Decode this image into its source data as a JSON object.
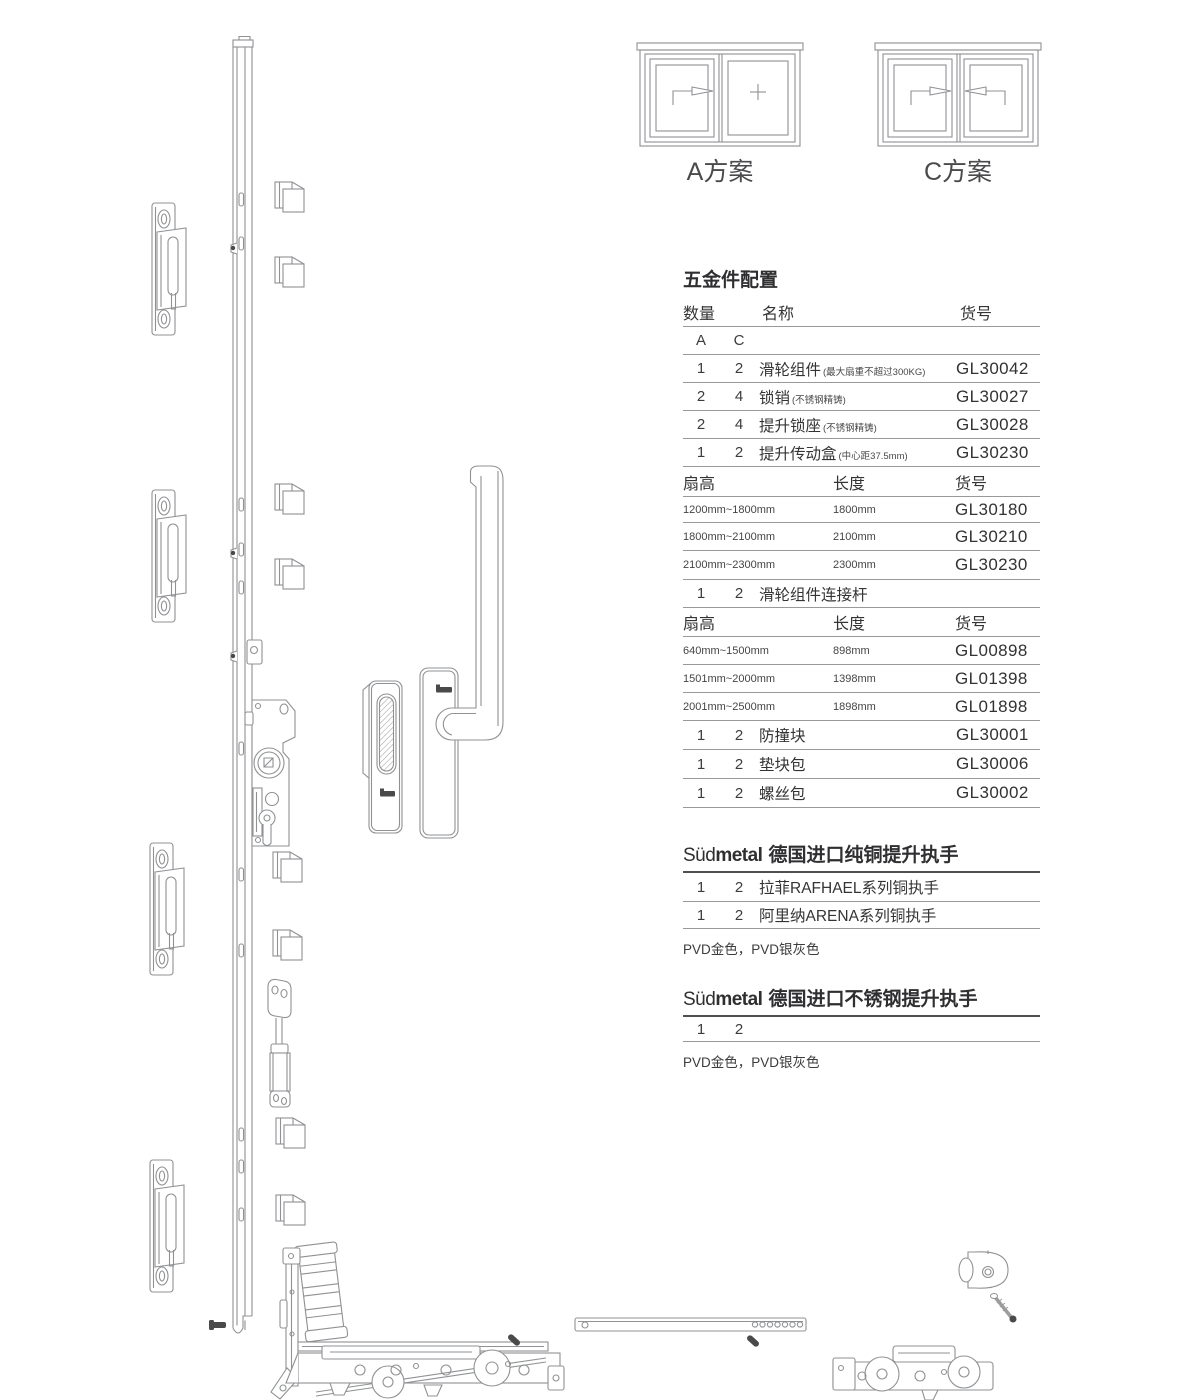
{
  "colors": {
    "line": "#8f9193",
    "text": "#3f3f41",
    "rule": "#97999b",
    "dark_rule": "#4f4f51",
    "pin_fill": "#4a4a4a",
    "background": "#ffffff"
  },
  "schemes": {
    "a": {
      "label": "A方案",
      "left_pane": "sliding-sash-arrow-right",
      "right_pane": "fixed-pane-plus"
    },
    "c": {
      "label": "C方案",
      "left_pane": "sliding-sash-arrow-right",
      "right_pane": "sliding-sash-arrow-left"
    }
  },
  "table": {
    "title": "五金件配置",
    "head": {
      "qty": "数量",
      "name": "名称",
      "code": "货号"
    },
    "variants": {
      "a": "A",
      "c": "C"
    },
    "parts1": [
      {
        "a": "1",
        "c": "2",
        "name": "滑轮组件",
        "note": "(最大扇重不超过300KG)",
        "code": "GL30042"
      },
      {
        "a": "2",
        "c": "4",
        "name": "锁销",
        "note": "(不锈钢精铸)",
        "code": "GL30027"
      },
      {
        "a": "2",
        "c": "4",
        "name": "提升锁座",
        "note": "(不锈钢精铸)",
        "code": "GL30028"
      },
      {
        "a": "1",
        "c": "2",
        "name": "提升传动盒",
        "note": "(中心距37.5mm)",
        "code": "GL30230"
      }
    ],
    "sub1": {
      "h1": "扇高",
      "h2": "长度",
      "h3": "货号"
    },
    "sizes1": [
      {
        "range": "1200mm~1800mm",
        "length": "1800mm",
        "code": "GL30180"
      },
      {
        "range": "1800mm~2100mm",
        "length": "2100mm",
        "code": "GL30210"
      },
      {
        "range": "2100mm~2300mm",
        "length": "2300mm",
        "code": "GL30230"
      }
    ],
    "connector": {
      "a": "1",
      "c": "2",
      "name": "滑轮组件连接杆"
    },
    "sub2": {
      "h1": "扇高",
      "h2": "长度",
      "h3": "货号"
    },
    "sizes2": [
      {
        "range": "640mm~1500mm",
        "length": "898mm",
        "code": "GL00898"
      },
      {
        "range": "1501mm~2000mm",
        "length": "1398mm",
        "code": "GL01398"
      },
      {
        "range": "2001mm~2500mm",
        "length": "1898mm",
        "code": "GL01898"
      }
    ],
    "parts2": [
      {
        "a": "1",
        "c": "2",
        "name": "防撞块",
        "code": "GL30001"
      },
      {
        "a": "1",
        "c": "2",
        "name": "垫块包",
        "code": "GL30006"
      },
      {
        "a": "1",
        "c": "2",
        "name": "螺丝包",
        "code": "GL30002"
      }
    ]
  },
  "brass": {
    "brand_a": "Süd",
    "brand_b": "metal",
    "title": "德国进口纯铜提升执手",
    "rows": [
      {
        "a": "1",
        "c": "2",
        "name": "拉菲RAFHAEL系列铜执手"
      },
      {
        "a": "1",
        "c": "2",
        "name": "阿里纳ARENA系列铜执手"
      }
    ],
    "finish": "PVD金色，PVD银灰色"
  },
  "steel": {
    "brand_a": "Süd",
    "brand_b": "metal",
    "title": "德国进口不锈钢提升执手",
    "row": {
      "a": "1",
      "c": "2"
    },
    "finish": "PVD金色，PVD银灰色"
  },
  "drawings": {
    "parts": [
      "lock-rail",
      "strike-plate",
      "lock-pin-block",
      "lift-gearbox",
      "flush-pull",
      "lift-handle",
      "gas-strut-link",
      "corner-guide",
      "corner-drive",
      "roller-carriage",
      "roller-bogie",
      "connection-rod",
      "anti-collision-block",
      "screw",
      "black-pin"
    ]
  }
}
